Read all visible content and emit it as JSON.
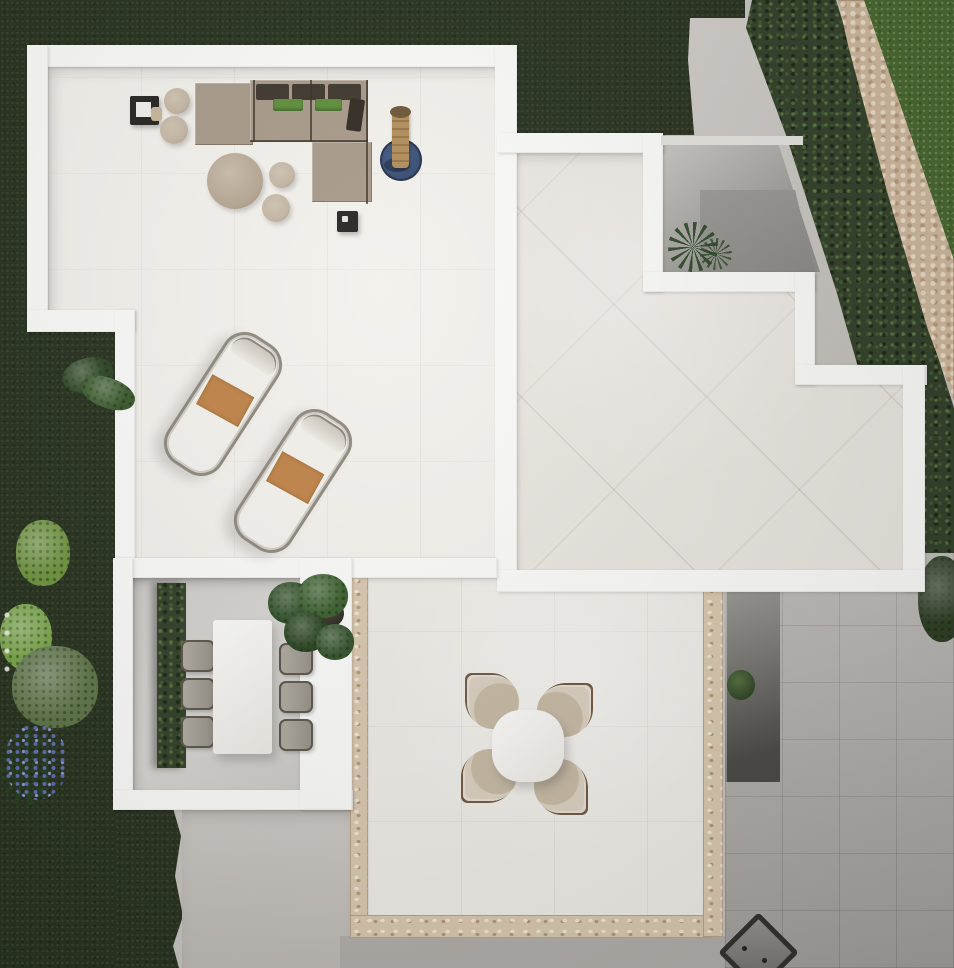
{
  "scene": {
    "type": "aerial-architectural-render",
    "description": "Top-down photorealistic render of a modern white villa roof terrace and garden",
    "areas": [
      {
        "name": "lounge-terrace",
        "position": "top-left",
        "floor": "white stone tiles"
      },
      {
        "name": "upper-terrace",
        "position": "right",
        "floor": "beige tiles laid diagonally",
        "outline": "stepped white parapet"
      },
      {
        "name": "sunken-courtyard",
        "position": "top-right of upper terrace",
        "floor": "gray concrete",
        "plants": 1
      },
      {
        "name": "dining-terrace",
        "position": "bottom-left",
        "floor": "gray concrete",
        "hedge_strip": true
      },
      {
        "name": "patio",
        "position": "bottom-center",
        "floor": "large light tiles",
        "border": "pebble mosaic strips"
      },
      {
        "name": "stairwell",
        "position": "right of patio",
        "floor": "dark recessed steps",
        "plants": 1
      },
      {
        "name": "garden",
        "position": "left and top edges",
        "ground": "dark green lawn"
      },
      {
        "name": "side-yard",
        "position": "bottom-right",
        "floor": "gray tiles"
      }
    ],
    "furniture": {
      "lounge_set": {
        "modules": [
          "chaise",
          "two-seat sofa",
          "corner return"
        ],
        "back_cushions": 3,
        "green_cushions": 2,
        "dark_pillow": 1
      },
      "side_tables": {
        "dark_square": 2,
        "round_poufs": 3,
        "round_coffee_table": 1,
        "small_round_table": 1
      },
      "sun_loungers": {
        "count": 2,
        "cushion": "white",
        "towels": 2
      },
      "heater_on_rug": {
        "column": "wood",
        "rug": "round navy"
      },
      "dining_set": {
        "table": "white rectangular",
        "chairs": 6,
        "planter": 1
      },
      "patio_set": {
        "table": "white round",
        "chairs": 4
      },
      "fire_pit": {
        "count": 1,
        "position": "bottom-right corner"
      }
    },
    "vegetation": {
      "hedge_diagonal": "top-right between lawn and stone path",
      "stone_path": "diagonal, top-right corner",
      "bushes_left": 4,
      "flower_clusters": [
        {
          "color": "blue-violet"
        },
        {
          "color": "white"
        }
      ],
      "edge_bush_right": 1
    }
  },
  "palette": {
    "grass": "#28321f",
    "grassBright": "#47662f",
    "hedge": "#32402a",
    "stone": "#cdb79c",
    "concrete": "#c6c3bf",
    "concreteDark": "#b0ada9",
    "wall": "#fafaf8",
    "floorWhite": "#f3f1ec",
    "tileBeige": "#e9e5df",
    "dining": "#d8d6d2",
    "patio": "#edebe5",
    "grayTiles": "#b8b5b1",
    "pebble": "#d8c7ae",
    "sofa": "#a89a89",
    "cushionDark": "#3f372d",
    "cushionGreen": "#5e8f3a",
    "pouf": "#c4b6a4",
    "towel": "#c08449",
    "rug": "#35496e",
    "wood": "#b18d5a",
    "wicker": "#948f85",
    "chairBeige": "#c6b9a4",
    "chairTrim": "#6f5943",
    "tableWhite": "#ebe9e3",
    "plant": "#2c4726",
    "stair": "#4a4945"
  }
}
